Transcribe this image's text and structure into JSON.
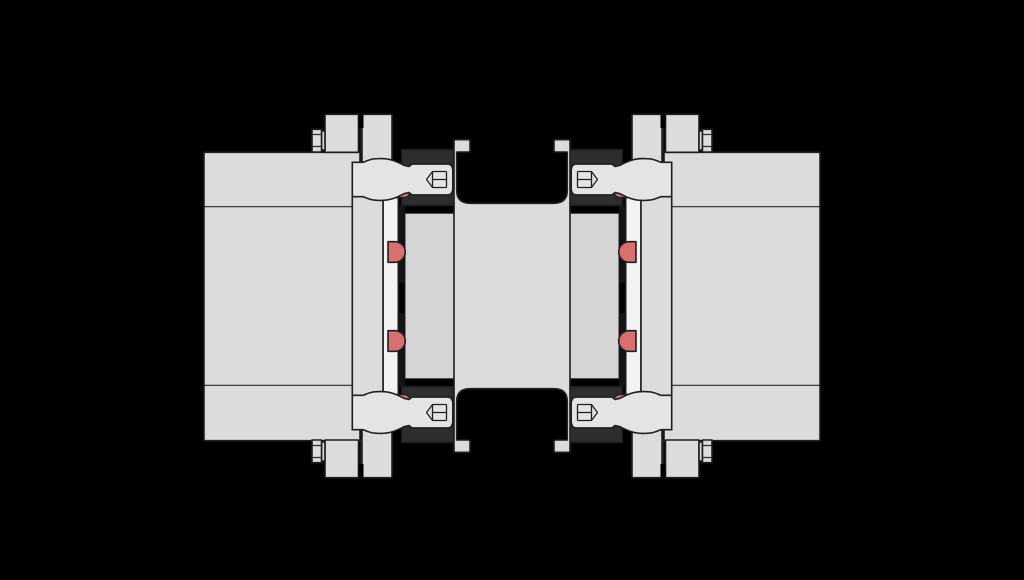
{
  "diagram": {
    "type": "technical-drawing",
    "subject": "Flexible disc-pack shaft coupling - axial cross-section",
    "view": "section view, black background, no dimensions or text labels",
    "colors": {
      "background": "#000000",
      "metal": "#dcdcdc",
      "metal_shaded": "#d5d5d5",
      "metal_light": "#f2f2f2",
      "metal_bolt": "#e4e4e4",
      "disc_pack_block": "#2d2d2d",
      "disc_pack_strip": "#141414",
      "elastomer": "#d97070",
      "elastomer_edge": "#7e2929",
      "outline": "#1f1f1f"
    },
    "parts": [
      {
        "id": "left-hub",
        "label": "Left hub"
      },
      {
        "id": "right-hub",
        "label": "Right hub"
      },
      {
        "id": "hub-flange-ring-left",
        "label": "Left hub flange ring"
      },
      {
        "id": "hub-flange-ring-right",
        "label": "Right hub flange ring"
      },
      {
        "id": "intermediate-flange-left",
        "label": "Left intermediate flange plate"
      },
      {
        "id": "intermediate-flange-right",
        "label": "Right intermediate flange plate"
      },
      {
        "id": "center-spacer",
        "label": "Center spacer tube with end flanges"
      },
      {
        "id": "disc-pack-left",
        "label": "Left lamellae disc pack"
      },
      {
        "id": "disc-pack-right",
        "label": "Right lamellae disc pack"
      },
      {
        "id": "socket-head-bolts",
        "label": "Socket head cap screws at flange joints",
        "count": 4
      },
      {
        "id": "elastomer-bushings",
        "label": "Red elastomer bushings",
        "count": 8
      },
      {
        "id": "clamp-screws",
        "label": "Small flange clamp screws",
        "count": 4
      }
    ]
  }
}
